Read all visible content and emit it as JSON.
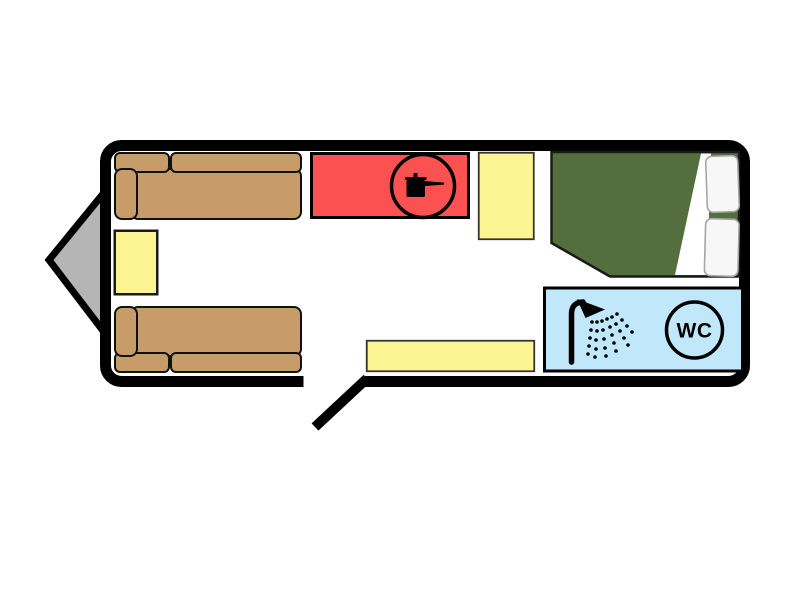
{
  "floorplan": {
    "title": "Caravan floor plan",
    "labels": {
      "wc": "WC"
    },
    "colors": {
      "background": "#ffffff",
      "wall": "#000000",
      "hitch": "#b5b5b5",
      "sofa": "#c79c69",
      "cabinet": "#fdf593",
      "kitchen": "#fb5150",
      "bed": "#556e3e",
      "bathroom": "#c0e8fa",
      "pillow": "#f7f7f7",
      "icon": "#000000"
    },
    "elements": [
      "tow-hitch",
      "front-sofa",
      "rear-sofa",
      "cabinet-left",
      "kitchen-hob",
      "cabinet-mid",
      "double-bed-with-pillows",
      "bathroom-with-shower-and-wc",
      "cabinet-bottom",
      "entry-door"
    ]
  }
}
